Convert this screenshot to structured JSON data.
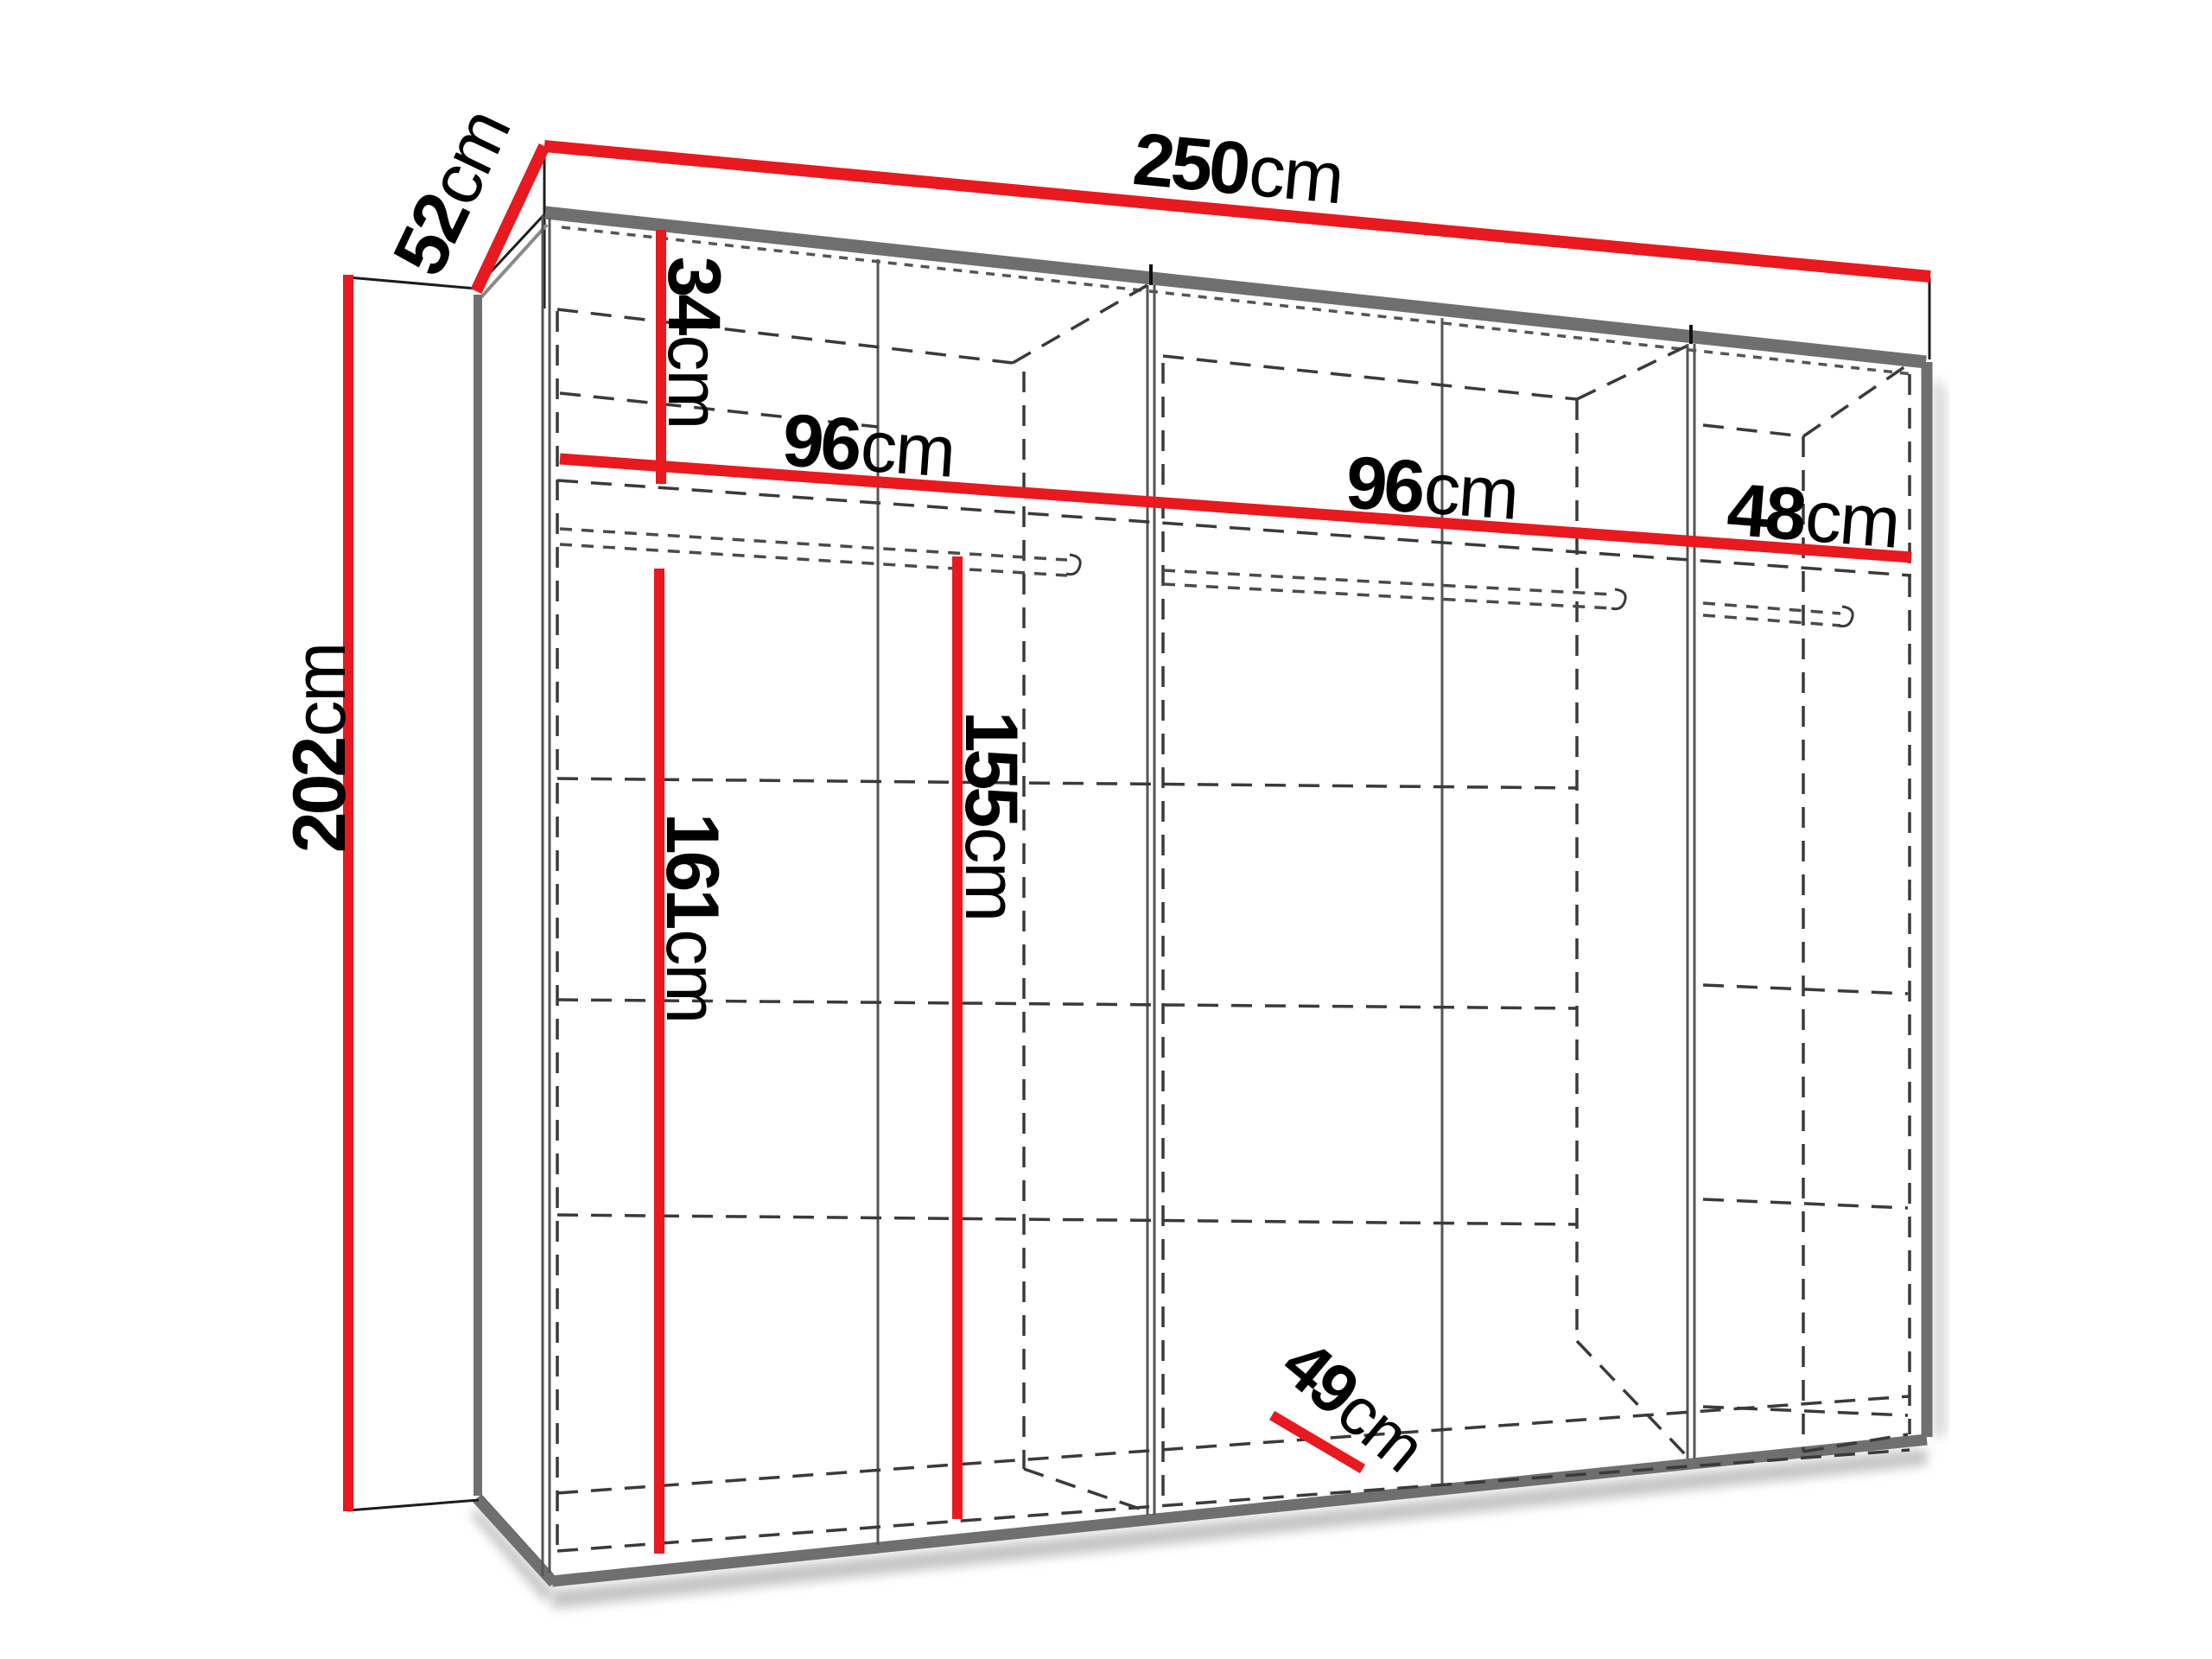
{
  "diagram": {
    "title": "wardrobe-dimension-diagram",
    "type": "technical-furniture-drawing",
    "accent_color": "#e8191f",
    "structure_color": "#6f6f6f",
    "dash_color": "#3a3a3a",
    "background_color": "#ffffff",
    "dimensions": {
      "width": {
        "value": "250",
        "unit": "cm"
      },
      "depth": {
        "value": "52",
        "unit": "cm"
      },
      "height": {
        "value": "202",
        "unit": "cm"
      },
      "top_shelf_height": {
        "value": "34",
        "unit": "cm"
      },
      "left_section": {
        "value": "96",
        "unit": "cm"
      },
      "middle_section": {
        "value": "96",
        "unit": "cm"
      },
      "right_section": {
        "value": "48",
        "unit": "cm"
      },
      "left_hanging": {
        "value": "161",
        "unit": "cm"
      },
      "middle_hanging": {
        "value": "155",
        "unit": "cm"
      },
      "interior_depth": {
        "value": "49",
        "unit": "cm"
      }
    }
  }
}
